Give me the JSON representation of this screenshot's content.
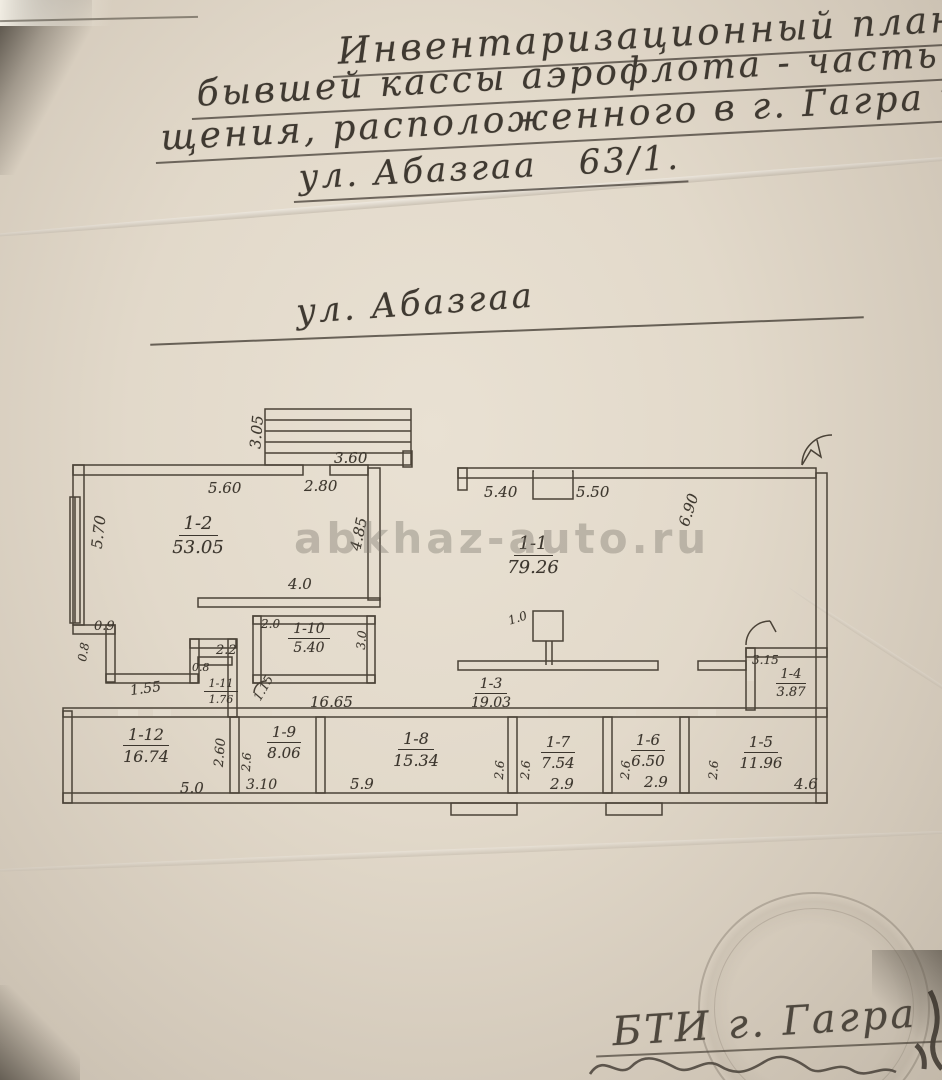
{
  "page": {
    "title_lines": [
      "Инвентаризационный план здан",
      "бывшей кассы аэрофлота - часть поме",
      "щения, расположенного в г. Гагра по",
      "ул. Абазгаа   63/1."
    ],
    "street_label": "ул. Абазгаа",
    "watermark": "abkhaz-auto.ru",
    "footer_line": "БТИ г. Гагра"
  },
  "plan": {
    "rooms": [
      {
        "id": "1-2",
        "area": "53.05"
      },
      {
        "id": "1-1",
        "area": "79.26"
      },
      {
        "id": "1-10",
        "area": "5.40"
      },
      {
        "id": "1-11",
        "area": "1.76"
      },
      {
        "id": "1-3",
        "area": "19.03"
      },
      {
        "id": "1-4",
        "area": "3.87"
      },
      {
        "id": "1-12",
        "area": "16.74"
      },
      {
        "id": "1-9",
        "area": "8.06"
      },
      {
        "id": "1-8",
        "area": "15.34"
      },
      {
        "id": "1-7",
        "area": "7.54"
      },
      {
        "id": "1-6",
        "area": "6.50"
      },
      {
        "id": "1-5",
        "area": "11.96"
      }
    ],
    "dims": {
      "top_560": "5.60",
      "top_280": "2.80",
      "stair_360": "3.60",
      "stair_305": "3.05",
      "left_570": "5.70",
      "mid_485": "4.85",
      "top_540": "5.40",
      "top_550": "5.50",
      "right_690": "6.90",
      "w_40": "4.0",
      "w_20": "2.0",
      "h_30": "3.0",
      "col_10": "1.0",
      "w_1665": "16.65",
      "w_09": "0.9",
      "v_08": "0.8",
      "w_155": "1.55",
      "w_08": "0.8",
      "w_22": "2.2",
      "d_115": "1.15",
      "w_315": "3.15",
      "b_50": "5.0",
      "v_260": "2.60",
      "v_26": "2.6",
      "b_310": "3.10",
      "b_59": "5.9",
      "b_29": "2.9",
      "b_46": "4.6"
    },
    "ink_color": "#4a4237",
    "paper_color": "#e3dbcd"
  }
}
